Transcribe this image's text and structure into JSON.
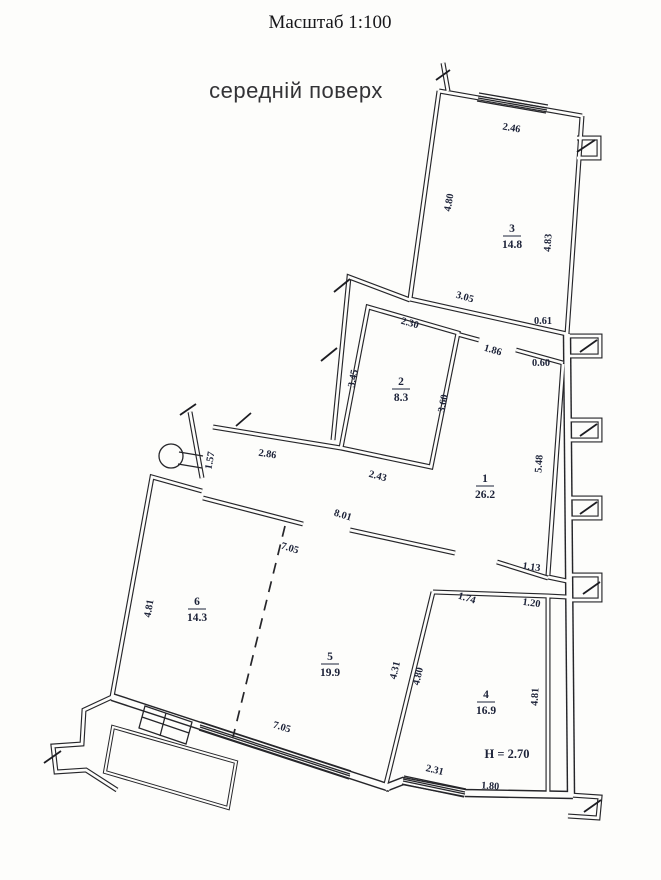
{
  "title": "Масштаб 1:100",
  "subtitle": "середній поверх",
  "drawing": {
    "type": "floor-plan",
    "scale": "1:100",
    "ink_color": "#26262a",
    "label_color": "#1c2238",
    "background": "#fdfdfb",
    "height_note": "H = 2.70",
    "rooms": [
      {
        "number": "1",
        "area": "26.2",
        "x": 485,
        "y": 486
      },
      {
        "number": "2",
        "area": "8.3",
        "x": 401,
        "y": 389
      },
      {
        "number": "3",
        "area": "14.8",
        "x": 512,
        "y": 236
      },
      {
        "number": "4",
        "area": "16.9",
        "x": 486,
        "y": 702
      },
      {
        "number": "5",
        "area": "19.9",
        "x": 330,
        "y": 664
      },
      {
        "number": "6",
        "area": "14.3",
        "x": 197,
        "y": 609
      }
    ],
    "dimensions": [
      {
        "text": "2.46",
        "x": 511,
        "y": 131,
        "rot": 10
      },
      {
        "text": "4.80",
        "x": 452,
        "y": 203,
        "rot": -80
      },
      {
        "text": "4.83",
        "x": 551,
        "y": 243,
        "rot": -86
      },
      {
        "text": "3.05",
        "x": 464,
        "y": 300,
        "rot": 16
      },
      {
        "text": "0.61",
        "x": 543,
        "y": 324,
        "rot": 0
      },
      {
        "text": "1.86",
        "x": 492,
        "y": 353,
        "rot": 16
      },
      {
        "text": "0.60",
        "x": 541,
        "y": 366,
        "rot": 0
      },
      {
        "text": "2.30",
        "x": 409,
        "y": 326,
        "rot": 16
      },
      {
        "text": "3.45",
        "x": 356,
        "y": 379,
        "rot": -79
      },
      {
        "text": "3.60",
        "x": 446,
        "y": 404,
        "rot": -79
      },
      {
        "text": "2.43",
        "x": 377,
        "y": 479,
        "rot": 15
      },
      {
        "text": "2.86",
        "x": 267,
        "y": 457,
        "rot": 9
      },
      {
        "text": "1.57",
        "x": 213,
        "y": 461,
        "rot": -80
      },
      {
        "text": "5.48",
        "x": 542,
        "y": 464,
        "rot": -86
      },
      {
        "text": "8.01",
        "x": 342,
        "y": 518,
        "rot": 17
      },
      {
        "text": "7.05",
        "x": 289,
        "y": 551,
        "rot": 17
      },
      {
        "text": "1.13",
        "x": 531,
        "y": 570,
        "rot": 8
      },
      {
        "text": "1.74",
        "x": 466,
        "y": 601,
        "rot": 17
      },
      {
        "text": "1.20",
        "x": 531,
        "y": 606,
        "rot": 8
      },
      {
        "text": "4.81",
        "x": 152,
        "y": 609,
        "rot": -80
      },
      {
        "text": "4.31",
        "x": 398,
        "y": 671,
        "rot": -76
      },
      {
        "text": "4.80",
        "x": 421,
        "y": 677,
        "rot": -76
      },
      {
        "text": "4.81",
        "x": 538,
        "y": 697,
        "rot": -87
      },
      {
        "text": "7.05",
        "x": 281,
        "y": 730,
        "rot": 17
      },
      {
        "text": "2.31",
        "x": 434,
        "y": 773,
        "rot": 14
      },
      {
        "text": "1.80",
        "x": 490,
        "y": 789,
        "rot": 4
      },
      {
        "text": "H = 2.70",
        "x": 507,
        "y": 758,
        "rot": 0,
        "big": true
      }
    ]
  }
}
